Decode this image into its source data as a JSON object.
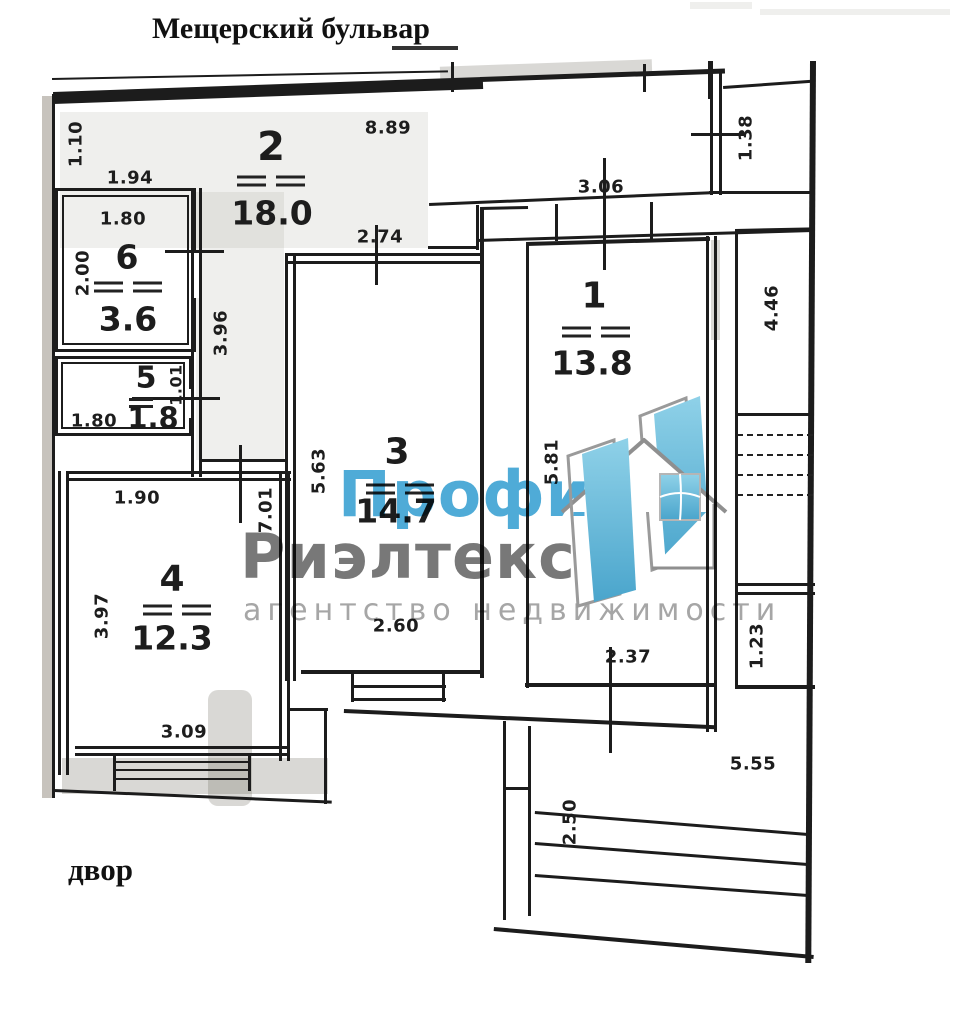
{
  "street_label": "Мещерский бульвар",
  "yard_label": "двор",
  "watermark": {
    "brand_top": "Профи",
    "brand_bottom": "Риэлтекс",
    "tagline": "агентство недвижимости",
    "blue": "#4fabd7",
    "gray": "#787878",
    "tagline_gray": "#a6a6a6"
  },
  "rooms": {
    "room1": {
      "number": "1",
      "area": "13.8"
    },
    "room2": {
      "number": "2",
      "area": "18.0"
    },
    "room3": {
      "number": "3",
      "area": "14.7"
    },
    "room4": {
      "number": "4",
      "area": "12.3"
    },
    "room5": {
      "number": "5",
      "area": "1.8"
    },
    "room6": {
      "number": "6",
      "area": "3.6"
    }
  },
  "dims": {
    "top_width": "8.89",
    "left_upper": "1.10",
    "left_offset": "1.94",
    "room6_width": "1.80",
    "room6_depth": "2.00",
    "hall_depth": "3.96",
    "room5_depth": "1.01",
    "room5_width": "1.80",
    "room4_upper_width": "1.90",
    "room4_depth": "3.97",
    "room4_width": "3.09",
    "hall_lower_depth": "7.01",
    "room3_top_width": "2.74",
    "room3_depth": "5.63",
    "room3_bottom_width": "2.60",
    "corridor_width": "3.06",
    "niche_depth": "1.38",
    "loggia_upper_depth": "4.46",
    "room1_depth": "5.81",
    "room1_width": "2.37",
    "loggia_lower_depth": "1.23",
    "terrace_width": "5.55",
    "terrace_depth": "2.50"
  }
}
